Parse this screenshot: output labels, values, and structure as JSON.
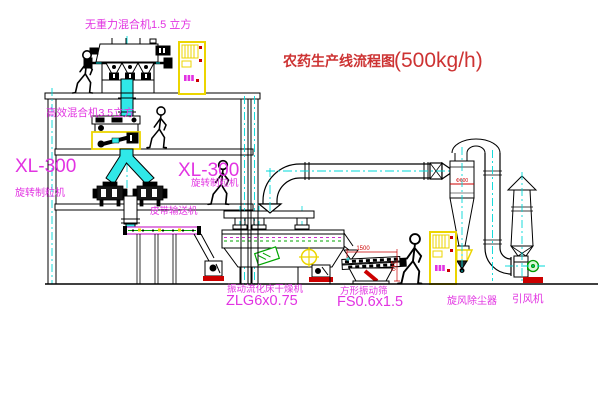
{
  "title": {
    "name": "农药生产线流程图",
    "capacity": "(500kg/h)"
  },
  "equipment_labels": {
    "gravity_mixer": "无重力混合机1.5 立方",
    "high_efficiency_mixer": "高效混合机3.5立方",
    "granulator_left_model": "XL-300",
    "granulator_left_name": "旋转制粒机",
    "granulator_right_model": "XL-300",
    "granulator_right_name": "旋转制粒机",
    "belt_conveyor": "皮带输送机",
    "fluid_bed_dryer_name": "振动流化床干燥机",
    "fluid_bed_dryer_model": "ZLG6x0.75",
    "square_sieve_name": "方形振动筛",
    "square_sieve_model": "FS0.6x1.5",
    "cyclone": "旋风除尘器",
    "induced_draft_fan": "引风机"
  },
  "dimensions": {
    "sieve_length": "1500",
    "sieve_height": "240",
    "cyclone_note": "Φ600"
  },
  "colors": {
    "label_magenta": "#e233e2",
    "title_red": "#cd3333",
    "dimension_red": "#cc0000",
    "centerline_cyan": "#00d8d8",
    "highlight_yellow": "#ecd500",
    "detail_green": "#00a500",
    "chute_cyan": "#30e8e8"
  }
}
